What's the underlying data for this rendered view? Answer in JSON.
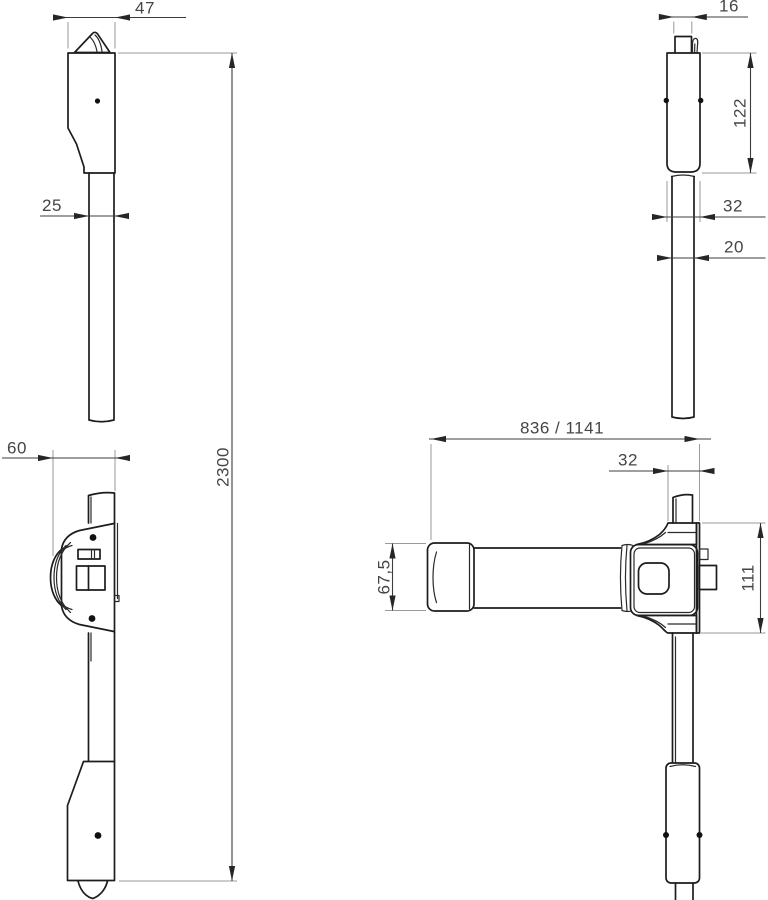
{
  "drawing": {
    "background": "#ffffff",
    "line_color": "#1d1d1d",
    "dim_color": "#3c3c3c",
    "dimensions": {
      "head_width": "47",
      "rod_width_front": "25",
      "bar_projection": "60",
      "overall_height": "2300",
      "top_tab_width": "16",
      "guide_body_height": "122",
      "guide_body_width": "32",
      "rod_width_side": "20",
      "bar_length_variants": "836 / 1141",
      "rod_offset_from_edge": "32",
      "bar_end_height": "67,5",
      "case_height": "111"
    }
  }
}
